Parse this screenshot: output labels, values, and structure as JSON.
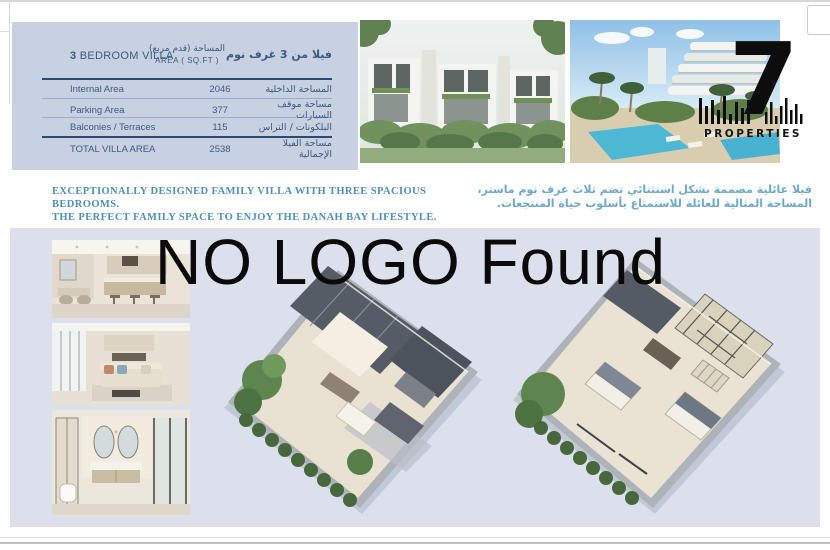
{
  "watermark": {
    "text": "NO LOGO Found"
  },
  "logo": {
    "number": "7",
    "name": "PROPERTIES"
  },
  "spec_table": {
    "title_number": "3",
    "title_rest": " BEDROOM VILLA",
    "area_header_ar": "المساحة (قدم مربع)",
    "area_header_en": "AREA ( SQ.FT )",
    "title_ar": "فيلا من 3 غرف نوم",
    "rows": [
      {
        "label_en": "Internal Area",
        "value": "2046",
        "label_ar": "المساحة الداخلية"
      },
      {
        "label_en": "Parking Area",
        "value": "377",
        "label_ar": "مساحة موقف السيارات"
      },
      {
        "label_en": "Balconies / Terraces",
        "value": "115",
        "label_ar": "البلكونات / التراس"
      },
      {
        "label_en": "TOTAL VILLA AREA",
        "value": "2538",
        "label_ar": "مساحة الفيلا الإجمالية"
      }
    ]
  },
  "tagline": {
    "en_line1": "EXCEPTIONALLY DESIGNED FAMILY VILLA WITH THREE SPACIOUS BEDROOMS.",
    "en_line2": "THE PERFECT FAMILY SPACE TO ENJOY THE DANAH BAY LIFESTYLE.",
    "ar_line1": "فيلا عائلية مصممة بشكل استثنائي تضم ثلاث غرف نوم ماستر،",
    "ar_line2": "المساحة المثالية للعائلة للاستمتاع بأسلوب حياة المنتجعات."
  },
  "colors": {
    "accent_navy": "#3d5a80",
    "table_bg": "#c8d1e1",
    "band_bg": "#dbe0ec",
    "tagline_blue": "#4f90b6",
    "tagline_arabic_blue": "#6ea9cd",
    "logo_black": "#0d0d0d"
  }
}
